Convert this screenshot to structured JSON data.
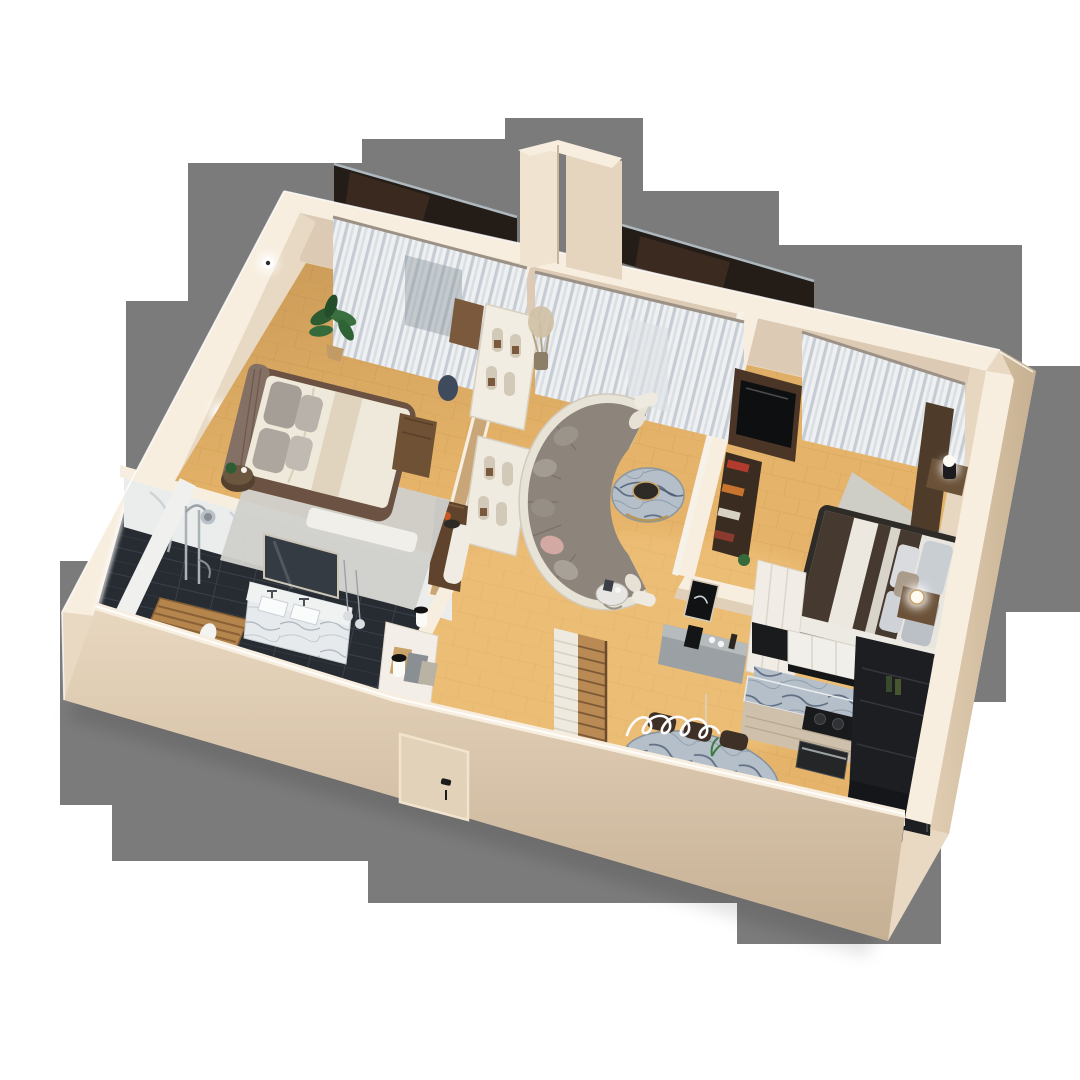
{
  "scene": {
    "description": "Photorealistic 3D isometric cutaway floor plan render of a two-bedroom apartment, viewed from above on a gray backdrop",
    "style": "3d-render",
    "view": "isometric top-down cutaway"
  },
  "palette": {
    "backdrop": "#7b7b7b",
    "page_bg": "#ffffff",
    "wall_top": "#f7eedf",
    "wall_mid": "#e9d8c2",
    "wall_inner": "#dccab4",
    "wall_front_light": "#e6d5bd",
    "wall_front_dark": "#c9b499",
    "floor_wood": "#e5b369",
    "bathroom_tile": "#272c33",
    "balcony_glass": "#241d17",
    "sofa_cushions": "#8d857b",
    "sofa_shell": "#e8e3d7",
    "bed_linen": "#efe9db",
    "bed2_throw": "#463a30",
    "area_rug": "#d0d0cc",
    "walnut_wood": "#6e5747",
    "kitchen_dark": "#1c1e22",
    "cabinet_white": "#f1efe9",
    "marble": "#b6c0c9",
    "stairs_wood": "#b98a54",
    "curtain": "#eef0f2",
    "accent_gold": "#c9a36a",
    "plant_green": "#2f5e35"
  },
  "rooms": [
    {
      "id": "bedroom-left",
      "furniture": [
        "double-bed",
        "tufted-headboard",
        "gray-pillows",
        "round-nightstand",
        "area-rug",
        "potted-plant",
        "walnut-wardrobe",
        "walnut-desk",
        "bench",
        "wall-spotlights",
        "window-curtain"
      ]
    },
    {
      "id": "bathroom",
      "furniture": [
        "marble-double-vanity",
        "mirror",
        "pendant-bulbs",
        "shower-set",
        "wooden-duckboard",
        "towel",
        "dark-tile-floor",
        "led-rim-light"
      ]
    },
    {
      "id": "living-room",
      "furniture": [
        "curved-sectional-sofa",
        "round-marble-coffee-table",
        "side-table",
        "arched-bookshelf",
        "open-walnut-door",
        "pedestal-vase",
        "dried-plant",
        "window-curtain"
      ]
    },
    {
      "id": "bedroom-right",
      "furniture": [
        "double-bed",
        "dark-throw",
        "headboard-panel",
        "nightstand-lamps",
        "tv-media-wall",
        "book-shelf",
        "closet",
        "bench",
        "area-rug",
        "window-curtain"
      ]
    },
    {
      "id": "kitchen",
      "furniture": [
        "white-upper-cabinets",
        "marble-counter",
        "cooktop",
        "oven",
        "tall-dark-cabinet",
        "sideboard-console",
        "wall-art"
      ]
    },
    {
      "id": "dining-entry",
      "furniture": [
        "oval-marble-table",
        "dining-chairs",
        "squiggle-pendant-light",
        "staircase-with-runner",
        "entry-console",
        "console-lamps",
        "front-door"
      ]
    }
  ],
  "exterior": {
    "features": [
      "balcony-glass-panels",
      "protruding-party-wall",
      "front-door",
      "cream-stucco-walls"
    ]
  }
}
